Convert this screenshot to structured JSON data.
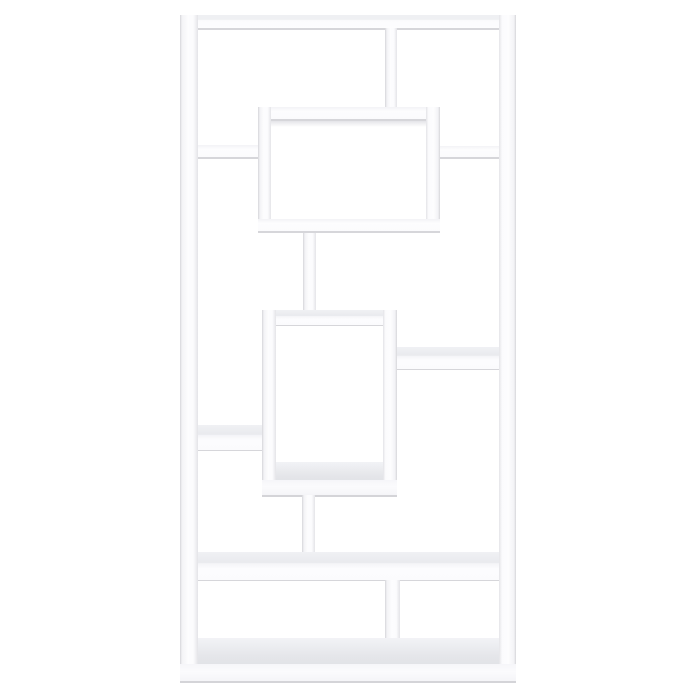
{
  "scene": {
    "type": "product-photo",
    "subject": "geometric-bookcase",
    "description": "Front view of a tall white geometric open bookcase with interlocking shelves, two offset display cubes, connector posts and a full-width lower shelf",
    "finish_color_name": "white",
    "visible_text": ""
  },
  "colors": {
    "background": "#ffffff",
    "furniture-face": "#fbfbfd",
    "furniture-face-dim": "#f3f3f6",
    "edge-shadow": "#d6d6da",
    "underside-shadow": "#e4e4e8",
    "top-surface": "#e9eaee",
    "floor-surface": "#e5e6ea"
  },
  "parts": {
    "top_panel": "top panel",
    "left_panel": "left side panel",
    "right_panel": "right side panel",
    "upper_divider": "upper vertical divider",
    "upper_cube": "upper display cube",
    "left_upper_shelf": "upper left shelf",
    "right_upper_shelf": "upper right shelf",
    "upper_post": "upper connector post",
    "middle_cube": "middle display cube",
    "right_middle_shelf": "middle right shelf",
    "left_lower_shelf": "lower left shelf",
    "lower_post": "lower connector post",
    "wide_shelf": "full-width lower shelf",
    "bottom_divider": "bottom vertical divider",
    "base_panel": "base panel"
  }
}
